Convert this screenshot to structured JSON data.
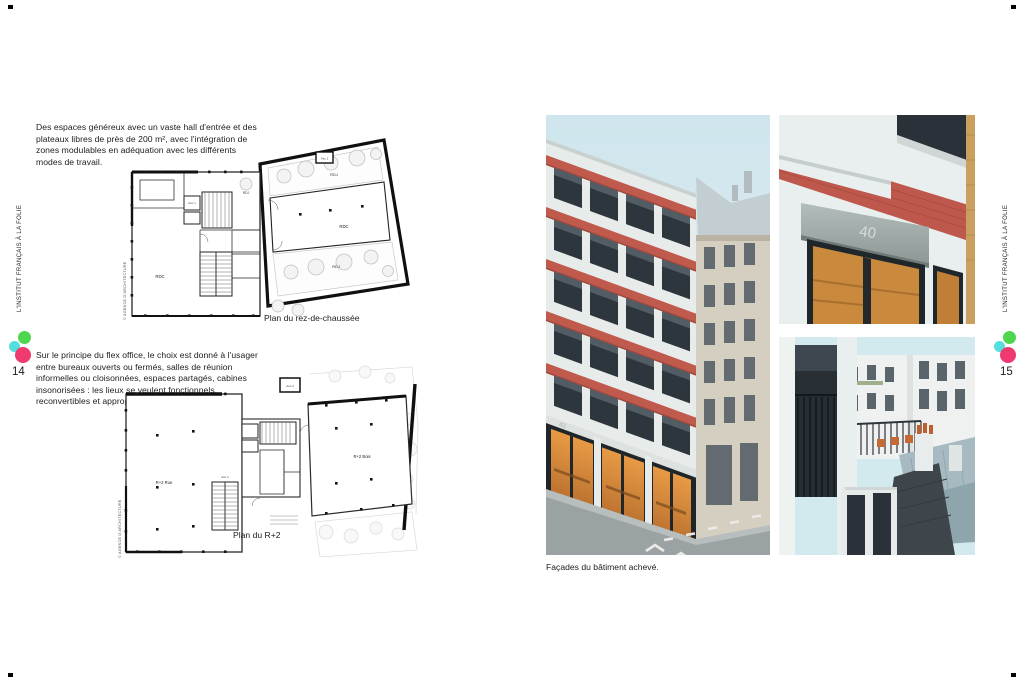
{
  "spread": {
    "left_page": {
      "margin_label": "L'INSTITUT FRANÇAIS À LA FOLIE",
      "page_number": "14",
      "intro_text": "Des espaces généreux avec un vaste hall d'entrée et des plateaux libres de près de 200 m², avec l'intégration de zones modulables en adéquation avec les différents modes de travail.",
      "flex_text": "Sur le principe du flex office, le choix est donné à l'usager entre bureaux ouverts ou fermés, salles de réunion informelles ou cloisonnées, espaces partagés, cabines insonorisées : les lieux se veulent fonctionnels, reconvertibles et appropriables.",
      "plan_ground": {
        "caption": "Plan du rez-de-chaussée",
        "credit": "© AGENCE D'ARCHITECTURE",
        "labels": {
          "rdc_left": "RDC",
          "rdc_main": "RDC",
          "rdj_top": "RDJ",
          "rdj_left": "RDJ",
          "rdj_bottom": "RDJ",
          "asc_1": "Asc 1",
          "asc_2": "Asc 2"
        }
      },
      "plan_r2": {
        "caption": "Plan du R+2",
        "credit": "© AGENCE D'ARCHITECTURE",
        "labels": {
          "street_wing": "R+2 Rue",
          "garden_wing": "R+2 Bois",
          "asc_1": "Asc 1",
          "asc_2": "Asc 2"
        }
      }
    },
    "right_page": {
      "margin_label": "L'INSTITUT FRANÇAIS À LA FOLIE",
      "page_number": "15",
      "photos_caption": "Façades du bâtiment achevé.",
      "street_number_facade": "42",
      "street_number_entrance": "40"
    },
    "logo_colors": {
      "green": "#4fd64f",
      "cyan": "#55dede",
      "pink": "#ee3a6e"
    },
    "accent_colors": {
      "brick_red": "#bf584c",
      "sky": "#d3e7ee",
      "warm_interior": "#cf8c3e",
      "zinc_roof": "#a7bac2"
    }
  }
}
